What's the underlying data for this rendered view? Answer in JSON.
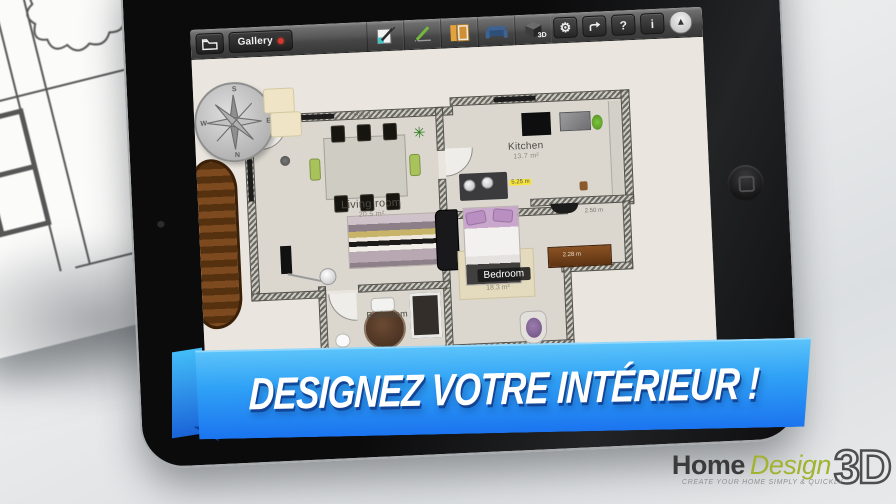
{
  "toolbar": {
    "gallery": "Gallery",
    "help": "?",
    "info": "i",
    "view3d_label": "3D",
    "icon_names": [
      "folder-icon",
      "draw-walls-icon",
      "pencil-icon",
      "door-window-icon",
      "furniture-sofa-icon",
      "view-3d-icon",
      "gear-icon",
      "share-icon",
      "help-icon",
      "info-icon",
      "compass-arrow-icon"
    ]
  },
  "plan": {
    "rooms": {
      "living": {
        "name": "Living room",
        "area": "20.5 m²"
      },
      "kitchen": {
        "name": "Kitchen",
        "area": "13.7 m²"
      },
      "bedroom": {
        "name": "Bedroom",
        "area": "18.3 m²"
      },
      "bathroom": {
        "name": "Bathroom"
      }
    },
    "measurements": {
      "table_width": "3.05 m",
      "kitchen_counter": "5.25 m",
      "hall_width": "2.50 m",
      "dresser_width": "2.28 m"
    },
    "compass": {
      "top": "S",
      "bottom": "N",
      "left": "W",
      "right": "E"
    }
  },
  "banner": {
    "text": "DESIGNEZ VOTRE INTÉRIEUR !"
  },
  "logo": {
    "word1": "Home",
    "word2": "Design",
    "word3": "3D",
    "tagline": "CREATE YOUR HOME SIMPLY & QUICKLY"
  },
  "sketch": {
    "labels": {
      "a": "860",
      "b": "5020",
      "c": "6400"
    }
  },
  "colors": {
    "banner_blue_top": "#5ec5fa",
    "banner_blue_bottom": "#1b74ef",
    "logo_green": "#a2b332",
    "gallery_dot_red": "#d33a2f",
    "highlight_yellow": "#f6e33c"
  }
}
